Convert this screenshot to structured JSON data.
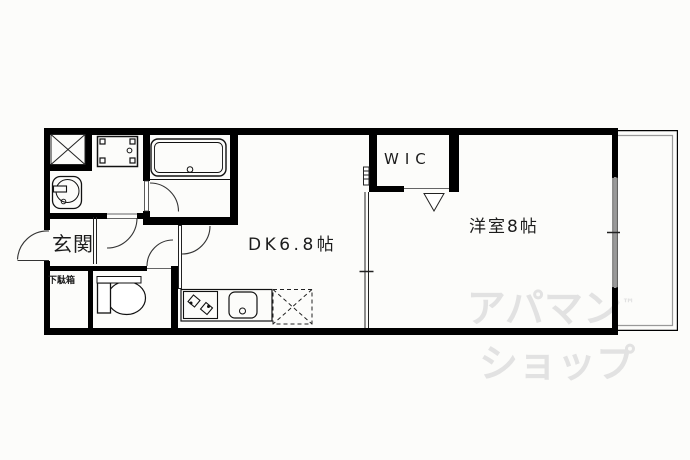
{
  "rooms": {
    "entrance_label": "玄関",
    "shoe_cabinet_label": "下駄箱",
    "wic_label": "WIC",
    "dining_kitchen_label": "DK6.8帖",
    "western_room_label": "洋室8帖"
  },
  "watermark": {
    "line1": "アパマン",
    "trademark": "™",
    "line2": "ショップ",
    "color": "#e2e2e2"
  },
  "colors": {
    "wall": "#000000",
    "thin_line": "#222222",
    "window_gray": "#999999",
    "background": "#fcfcfa"
  },
  "fixtures": {
    "closet": "x-closet",
    "washer": "washing-machine-pan",
    "bath": "bathtub",
    "basin": "washbasin",
    "toilet": "toilet",
    "stove": "gas-stove",
    "sink": "kitchen-sink",
    "fridge": "refrigerator-space"
  }
}
